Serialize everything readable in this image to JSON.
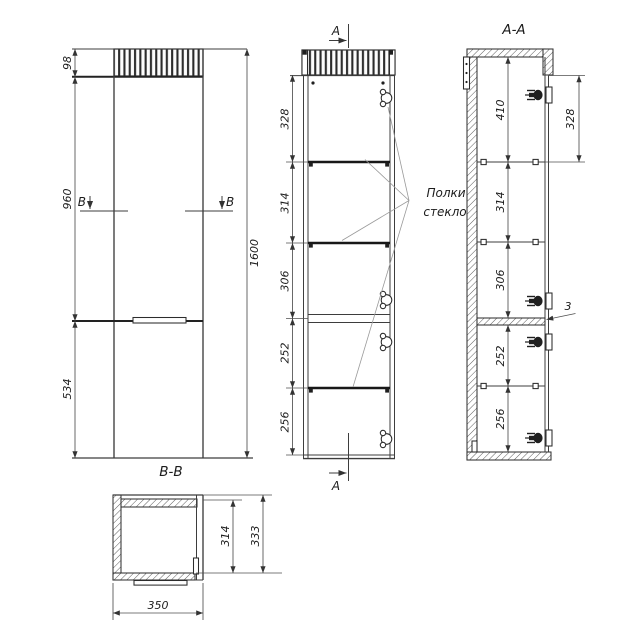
{
  "drawing": {
    "colors": {
      "background": "#ffffff",
      "object_line": "#3d3d3d",
      "thick_line": "#181818",
      "dimension_line": "#4f4f4f",
      "text": "#1c1c1c"
    },
    "views": {
      "front": {
        "name_label": "В-В",
        "section_letter": "В",
        "dim_cornice_height": "98",
        "dim_upper_height": "960",
        "dim_lower_height": "534",
        "dim_total_height": "1600"
      },
      "vertical_section": {
        "section_letter": "А",
        "dim_1": "328",
        "dim_2": "314",
        "dim_3": "306",
        "dim_4": "252",
        "dim_5": "256",
        "annotation_line1": "Полки",
        "annotation_line2": "стекло"
      },
      "section_aa": {
        "title": "А-А",
        "dim_top": "410",
        "dim_right": "328",
        "dim_2": "314",
        "dim_3": "306",
        "dim_4": "252",
        "dim_5": "256",
        "dim_gap": "3"
      },
      "plan": {
        "dim_inner_depth": "314",
        "dim_outer_depth": "333",
        "dim_width": "350"
      }
    }
  }
}
